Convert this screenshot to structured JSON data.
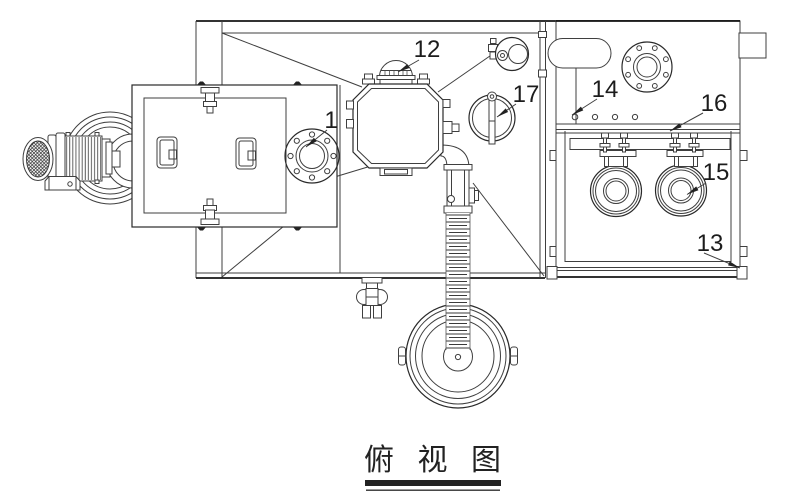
{
  "drawing": {
    "title_caption": "俯 视 图",
    "callouts": {
      "n1": "1",
      "n12": "12",
      "n13": "13",
      "n14": "14",
      "n15": "15",
      "n16": "16",
      "n17": "17"
    }
  }
}
